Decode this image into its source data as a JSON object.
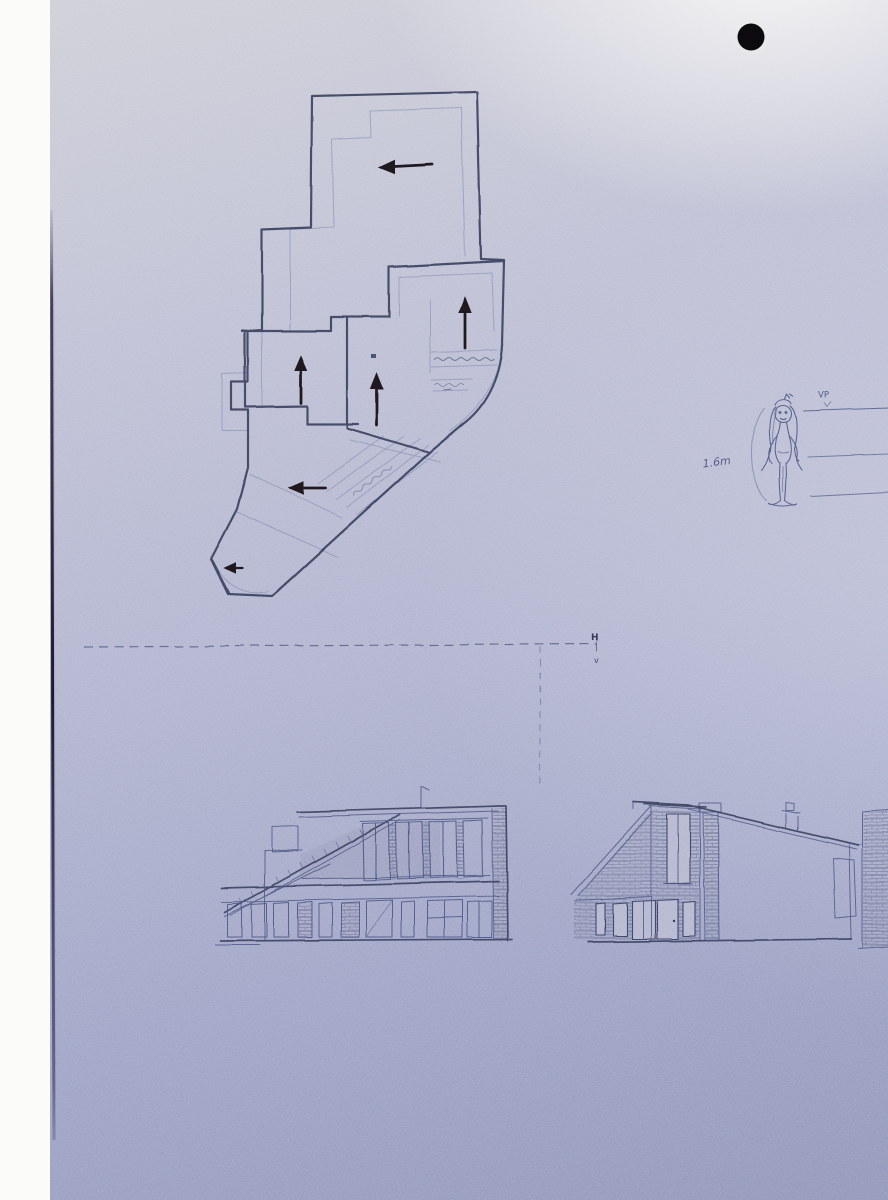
{
  "scene": {
    "description": "Pencil architectural sketch on blue-grey paper: floor plan with flow arrows, scale figure, datum line and two house elevations",
    "colors": {
      "paper_highlight": "#e3e4e6",
      "paper_mid": "#b2b5cf",
      "paper_shadow": "#8b92b6",
      "pencil_dark": "#333a56",
      "pencil_faint": "#6f77a6",
      "marker_arrow": "#1f161a",
      "hole_dot": "#0b090d"
    }
  },
  "floor_plan": {
    "arrows": [
      {
        "id": "upper-room",
        "direction": "left"
      },
      {
        "id": "mid-left-room",
        "direction": "up"
      },
      {
        "id": "mid-center-room",
        "direction": "up"
      },
      {
        "id": "right-room",
        "direction": "up"
      },
      {
        "id": "lower-room",
        "direction": "left"
      },
      {
        "id": "entry-tip",
        "direction": "left"
      }
    ]
  },
  "scale_figure": {
    "height_label": "1.6m",
    "vanishing_point_label": "VP"
  },
  "datum": {
    "horizontal_label": "H",
    "vertical_label": "v"
  }
}
